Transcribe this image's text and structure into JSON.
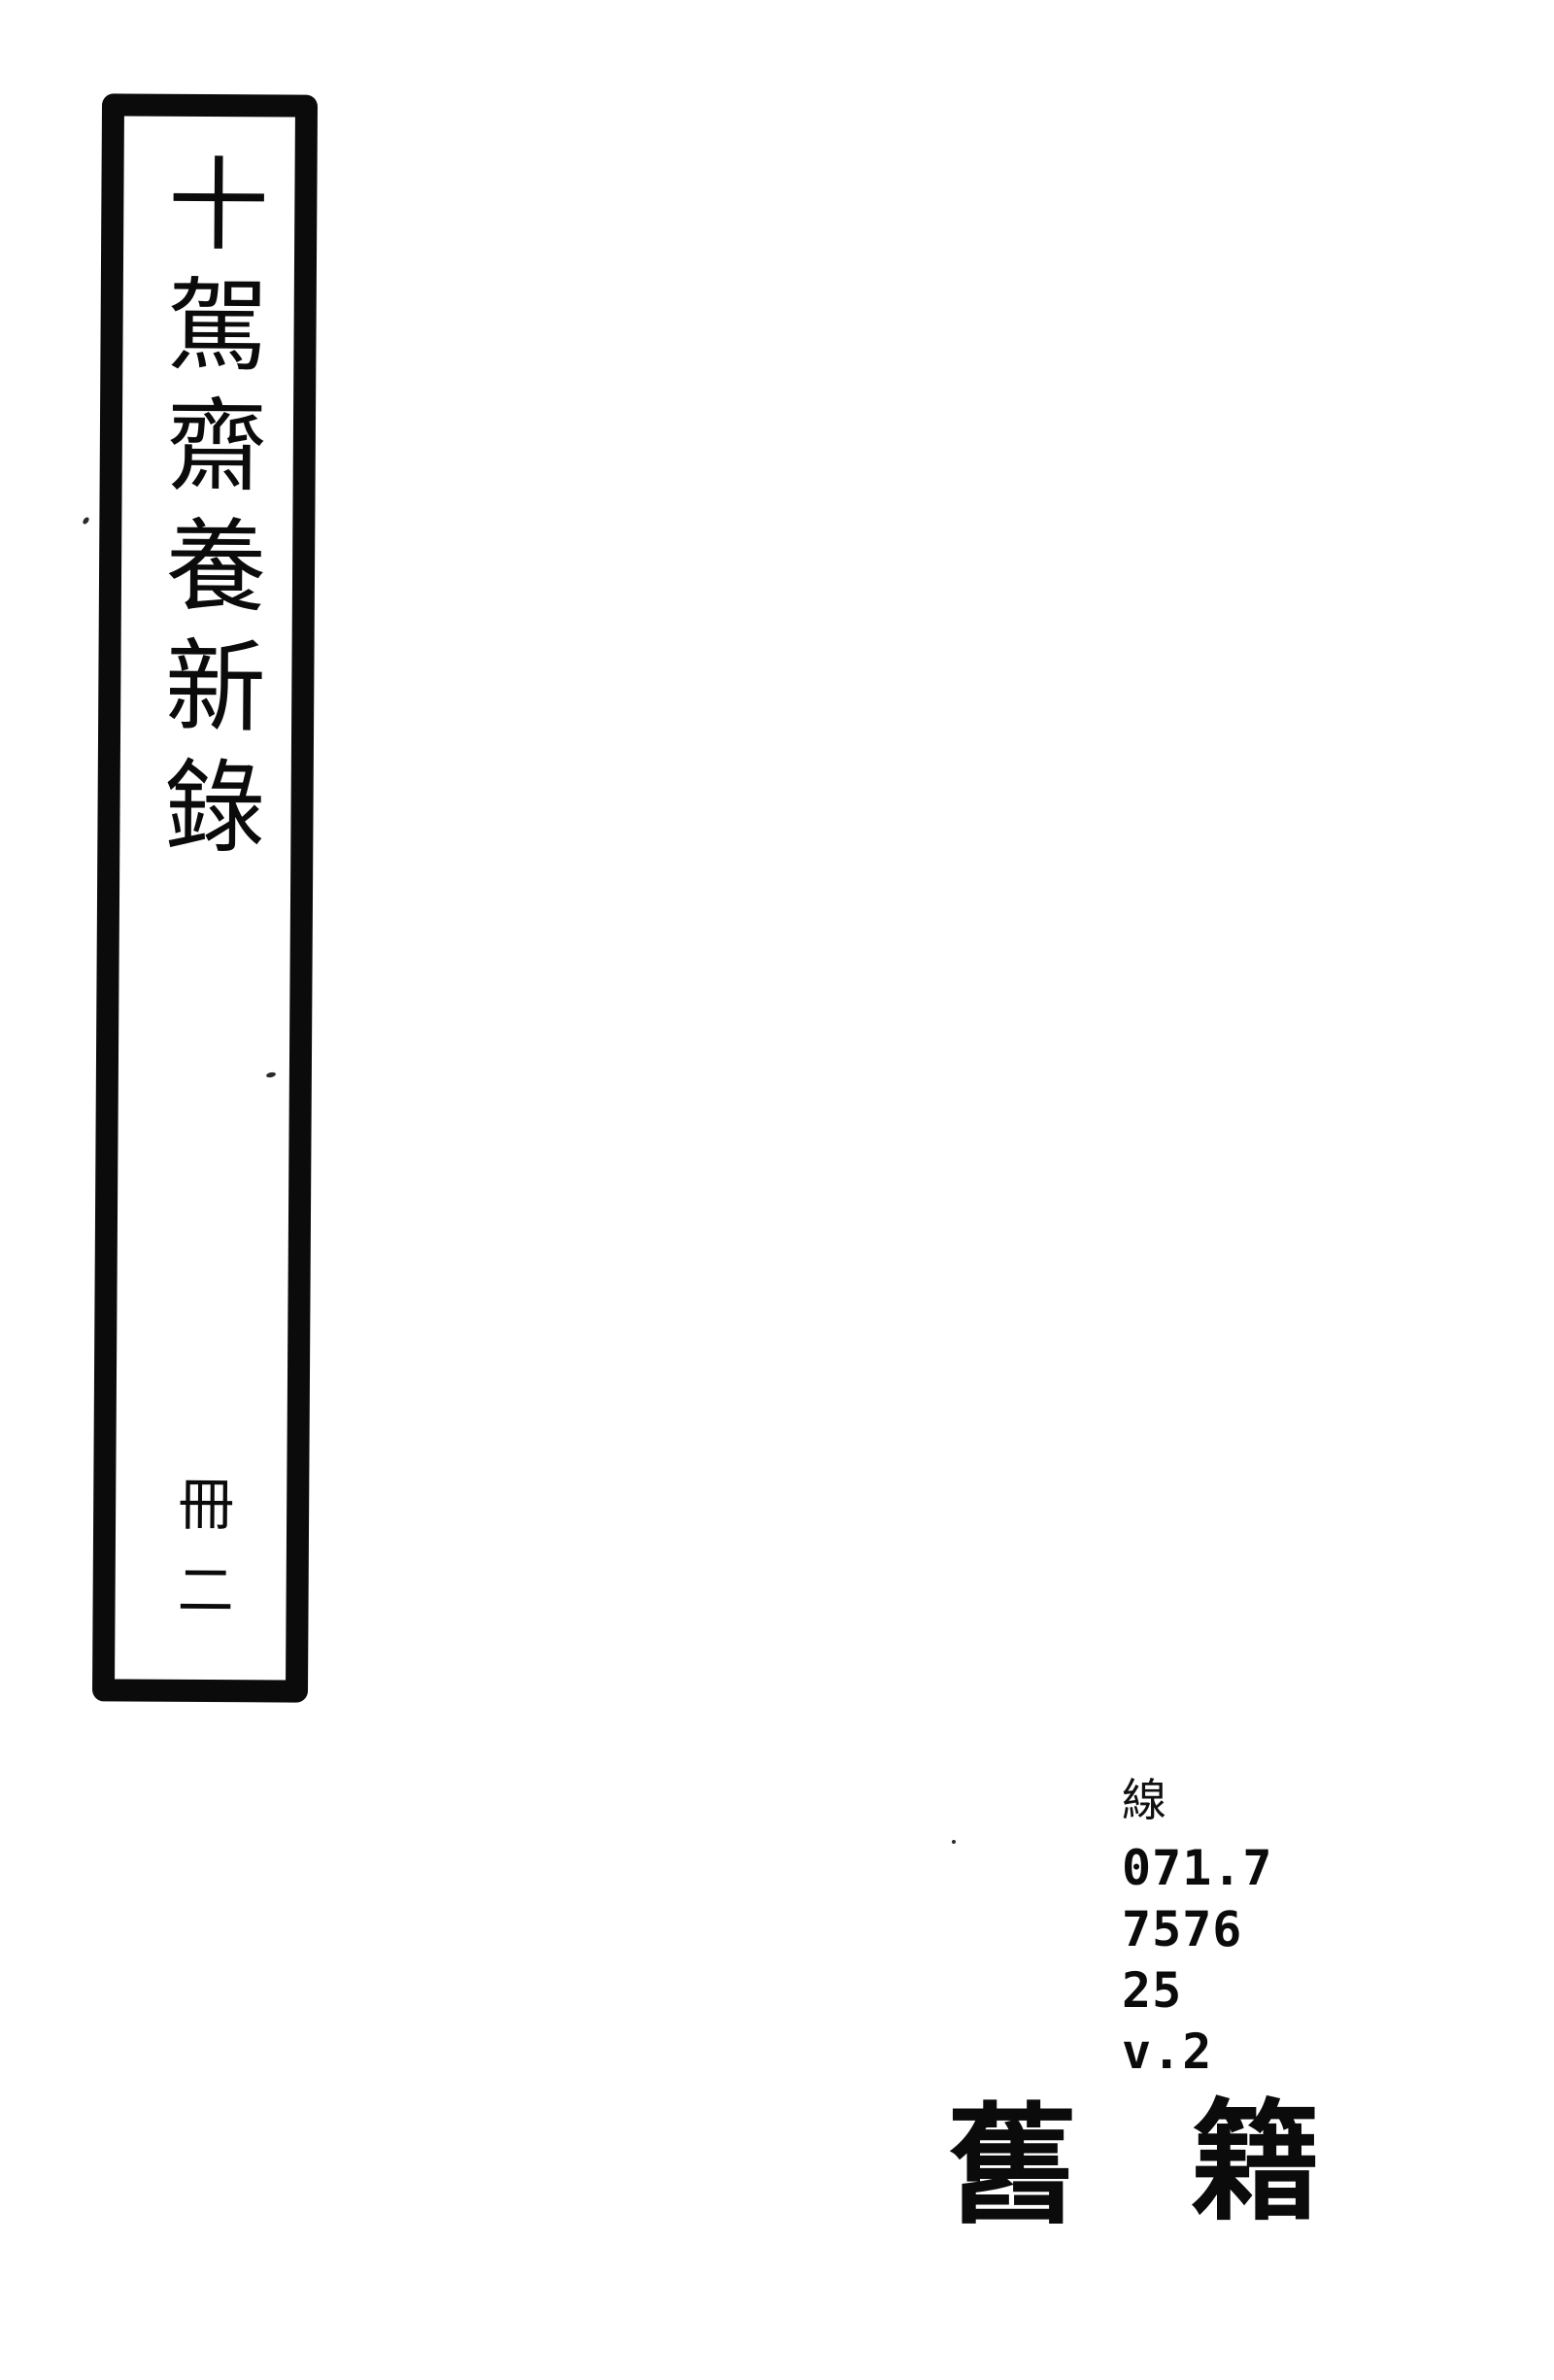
{
  "page": {
    "background": "#ffffff",
    "ink_color": "#0b0b0b"
  },
  "spine_label": {
    "title": "十駕齋養新錄",
    "volume": "冊二"
  },
  "library_marking": {
    "binding_char": "線",
    "call_number_lines": [
      "071.7",
      "7576",
      "25",
      "v.2"
    ],
    "category": "舊籍",
    "category_chars": [
      "舊",
      "籍"
    ]
  }
}
